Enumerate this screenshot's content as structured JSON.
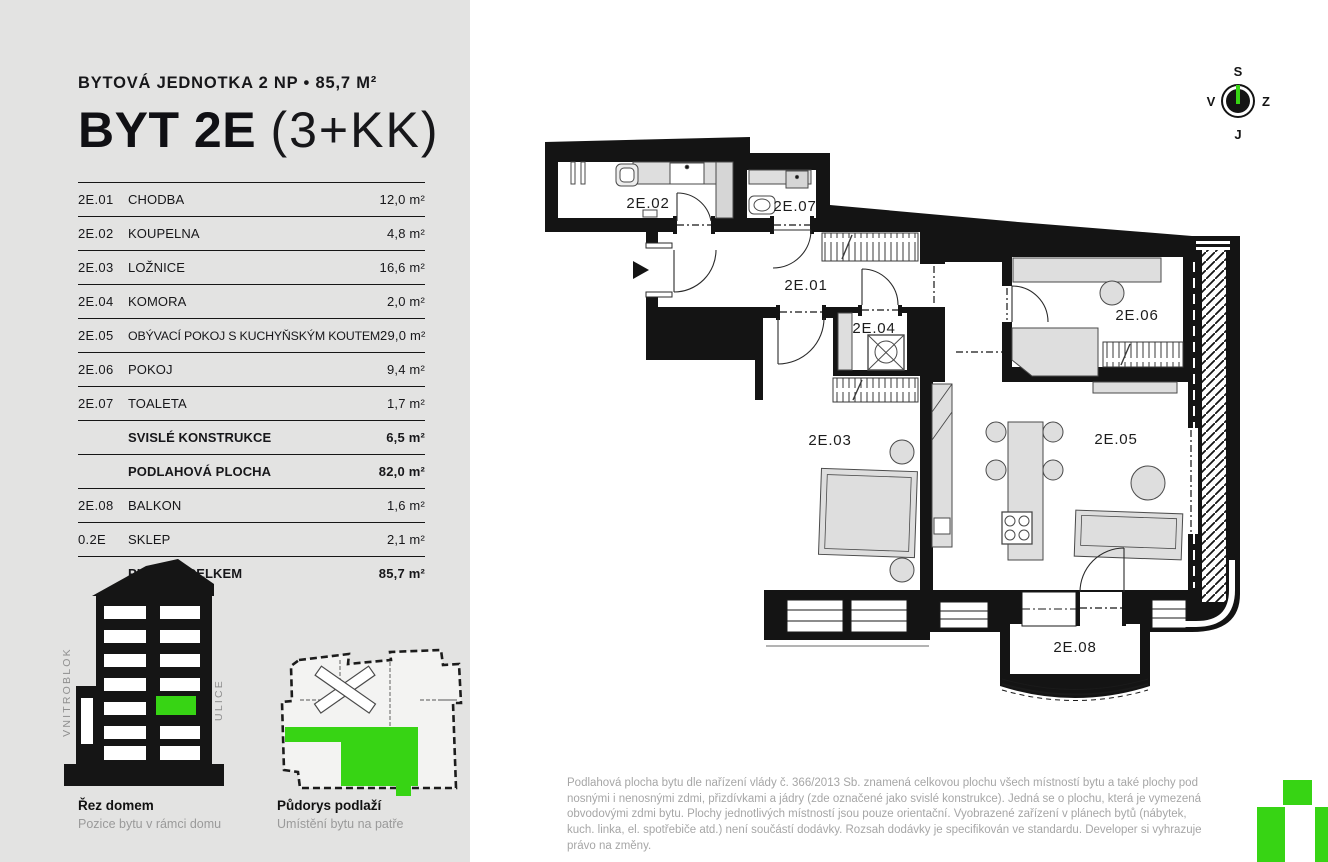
{
  "page": {
    "panel_bg": "#e3e3e2",
    "accent_green": "#37d414",
    "ink": "#141414",
    "furniture_fill": "#dedede",
    "muted_text": "#a6a6a6"
  },
  "header": {
    "kicker": "BYTOVÁ JEDNOTKA 2 NP • 85,7 M²",
    "title_main": "BYT 2E",
    "title_suffix": "(3+KK)"
  },
  "area_table": {
    "rows": [
      {
        "code": "2E.01",
        "name": "CHODBA",
        "value": "12,0 m²"
      },
      {
        "code": "2E.02",
        "name": "KOUPELNA",
        "value": "4,8 m²"
      },
      {
        "code": "2E.03",
        "name": "LOŽNICE",
        "value": "16,6 m²"
      },
      {
        "code": "2E.04",
        "name": "KOMORA",
        "value": "2,0 m²"
      },
      {
        "code": "2E.05",
        "name": "OBÝVACÍ POKOJ S KUCHYŇSKÝM KOUTEM",
        "value": "29,0 m²"
      },
      {
        "code": "2E.06",
        "name": "POKOJ",
        "value": "9,4 m²"
      },
      {
        "code": "2E.07",
        "name": "TOALETA",
        "value": "1,7 m²"
      },
      {
        "code": "",
        "name": "SVISLÉ KONSTRUKCE",
        "value": "6,5 m²"
      },
      {
        "code": "",
        "name": "PODLAHOVÁ PLOCHA",
        "value": "82,0 m²"
      },
      {
        "code": "2E.08",
        "name": "BALKON",
        "value": "1,6 m²"
      },
      {
        "code": "0.2E",
        "name": "SKLEP",
        "value": "2,1 m²"
      },
      {
        "code": "",
        "name": "PLOCHA CELKEM",
        "value": "85,7 m²"
      }
    ]
  },
  "diagrams": {
    "section": {
      "title": "Řez domem",
      "subtitle": "Pozice bytu v rámci domu",
      "label_left": "VNITROBLOK",
      "label_right": "ULICE"
    },
    "floor": {
      "title": "Půdorys podlaží",
      "subtitle": "Umístění bytu na patře"
    }
  },
  "plan": {
    "labels": {
      "r01": "2E.01",
      "r02": "2E.02",
      "r03": "2E.03",
      "r04": "2E.04",
      "r05": "2E.05",
      "r06": "2E.06",
      "r07": "2E.07",
      "r08": "2E.08"
    }
  },
  "compass": {
    "top": "S",
    "bottom": "J",
    "left": "V",
    "right": "Z"
  },
  "disclaimer": "Podlahová plocha bytu dle nařízení vlády č. 366/2013 Sb. znamená celkovou plochu všech místností bytu a také plochy pod nosnými i nenosnými zdmi, přizdívkami a jádry (zde označené jako svislé konstrukce). Jedná se o plochu, která je vymezená obvodovými zdmi bytu. Plochy jednotlivých místností jsou pouze orientační. Vyobrazené zařízení v plánech bytů (nábytek, kuch. linka, el. spotřebiče atd.) není součástí dodávky. Rozsah dodávky je specifikován ve standardu. Developer si vyhrazuje právo na změny."
}
